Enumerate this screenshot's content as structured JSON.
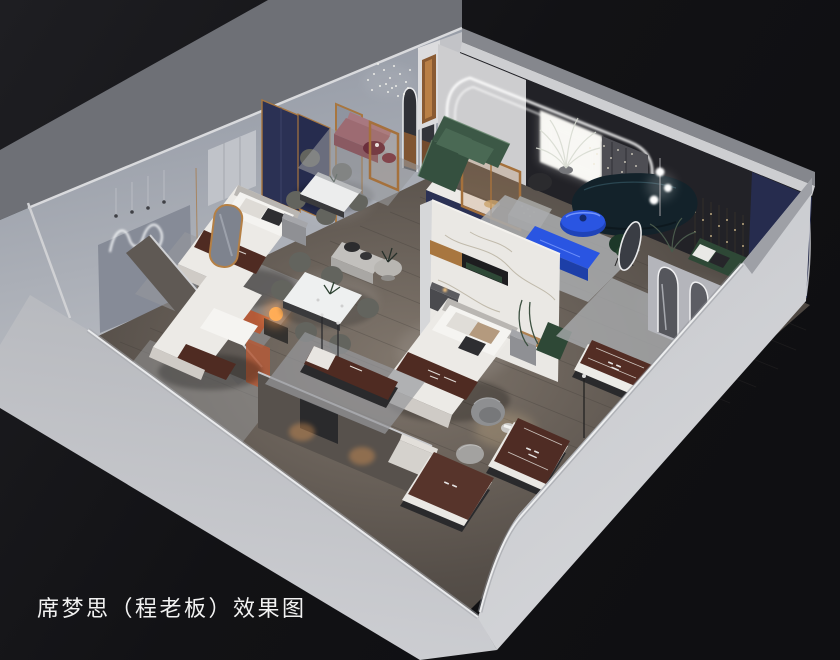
{
  "caption": {
    "text": "席梦思（程老板）效果图"
  },
  "scene": {
    "type": "3d-isometric-interior-render",
    "objects": [
      "backdrop-wall",
      "back-left-wall",
      "back-right-wall",
      "front-left-cut-wall",
      "front-right-cut-wall",
      "wood-floor",
      "wavy-neon-wall-light",
      "pendant-cord-lights",
      "dot-grid-chandelier",
      "bedroom-1-bed",
      "navy-fabric-panels",
      "gold-frame-screen",
      "gold-floor-mirror",
      "wardrobe-panel",
      "nightstand",
      "bedroom-2-bed",
      "orange-headboard",
      "glow-orb-lamp",
      "partition-wall-1",
      "partition-wall-2",
      "dining-set-upper",
      "dining-set-lower",
      "marble-feature-wall",
      "bedroom-3-bed",
      "green-bench-strip",
      "long-display-bench",
      "round-pedestal-table",
      "black-side-tables",
      "white-media-console",
      "mauve-bench",
      "burgundy-coffee-tables",
      "wood-glass-partition",
      "green-sectional-sofa",
      "white-palm-plant",
      "knit-ottoman",
      "dark-armchair",
      "led-arch-opening",
      "mini-arch-niches",
      "backlit-light-panel",
      "teal-curved-sofa",
      "blue-oval-coffee-table",
      "blue-tv-console",
      "globe-floor-lamp",
      "green-accent-chair",
      "string-light-cascade",
      "navy-accent-wall",
      "oval-floor-mirror",
      "arch-mirror-partition",
      "green-pillow-bench",
      "mattress-display-1",
      "mattress-display-2",
      "mattress-display-3",
      "mattress-display-4",
      "barrel-swivel-chairs",
      "round-service-table",
      "ribbed-pouf",
      "lounge-chair",
      "thin-floor-lamps",
      "area-rugs"
    ]
  },
  "colors": {
    "bg1": "#1e1e22",
    "bg2": "#101013",
    "bg3": "#17171a",
    "outerTop": "#6e7076",
    "outerFaceTop": "#8e94a0",
    "outerFaceBot": "#b9bcc2",
    "lip": "#d9dadd",
    "backwallDark": "#222227",
    "whiteWall": "#cdcdcf",
    "backlitPanel": "#f5f4ef",
    "navyPanel": "#262c4e",
    "navyFabric": "#2b3154",
    "led": "#ffffff",
    "bandL1": "#b7b9be",
    "bandL2": "#d0d1d5",
    "bandR1": "#c3c5ca",
    "bandR2": "#d6d7da",
    "bandEdge": "#eceded",
    "floorLight": "#80766c",
    "floorMid": "#564f49",
    "floorDark": "#423d38",
    "plank": "#3c3834",
    "rug": "#a9abae",
    "rugDark": "#97999c",
    "marble": "#eae8e4",
    "marbleVein": "#b3ab99",
    "gold": "#a8763f",
    "woodDoor": "#8a5a32",
    "bedWhite": "#eceae6",
    "bedShade": "#cfcbc6",
    "runner": "#4f2b22",
    "mattressBase": "#2a2a2c",
    "headOrange": "#b45a38",
    "warm": "#ffb366",
    "greenSofa": "#3c5846",
    "greenBench": "#2e4836",
    "greenChair": "#1d3829",
    "tealSofa": "#13222a",
    "blue": "#2a55e2",
    "blueDark": "#1d3fa8",
    "mauve": "#9d6b72",
    "burgundy": "#6b2e3c",
    "chairGray": "#8e8f91",
    "chairDine": "#63645e",
    "benchLight": "#c2c0bd",
    "partition": "#5f5954",
    "partition2": "#57514c",
    "caption": "#f2f2f2"
  }
}
